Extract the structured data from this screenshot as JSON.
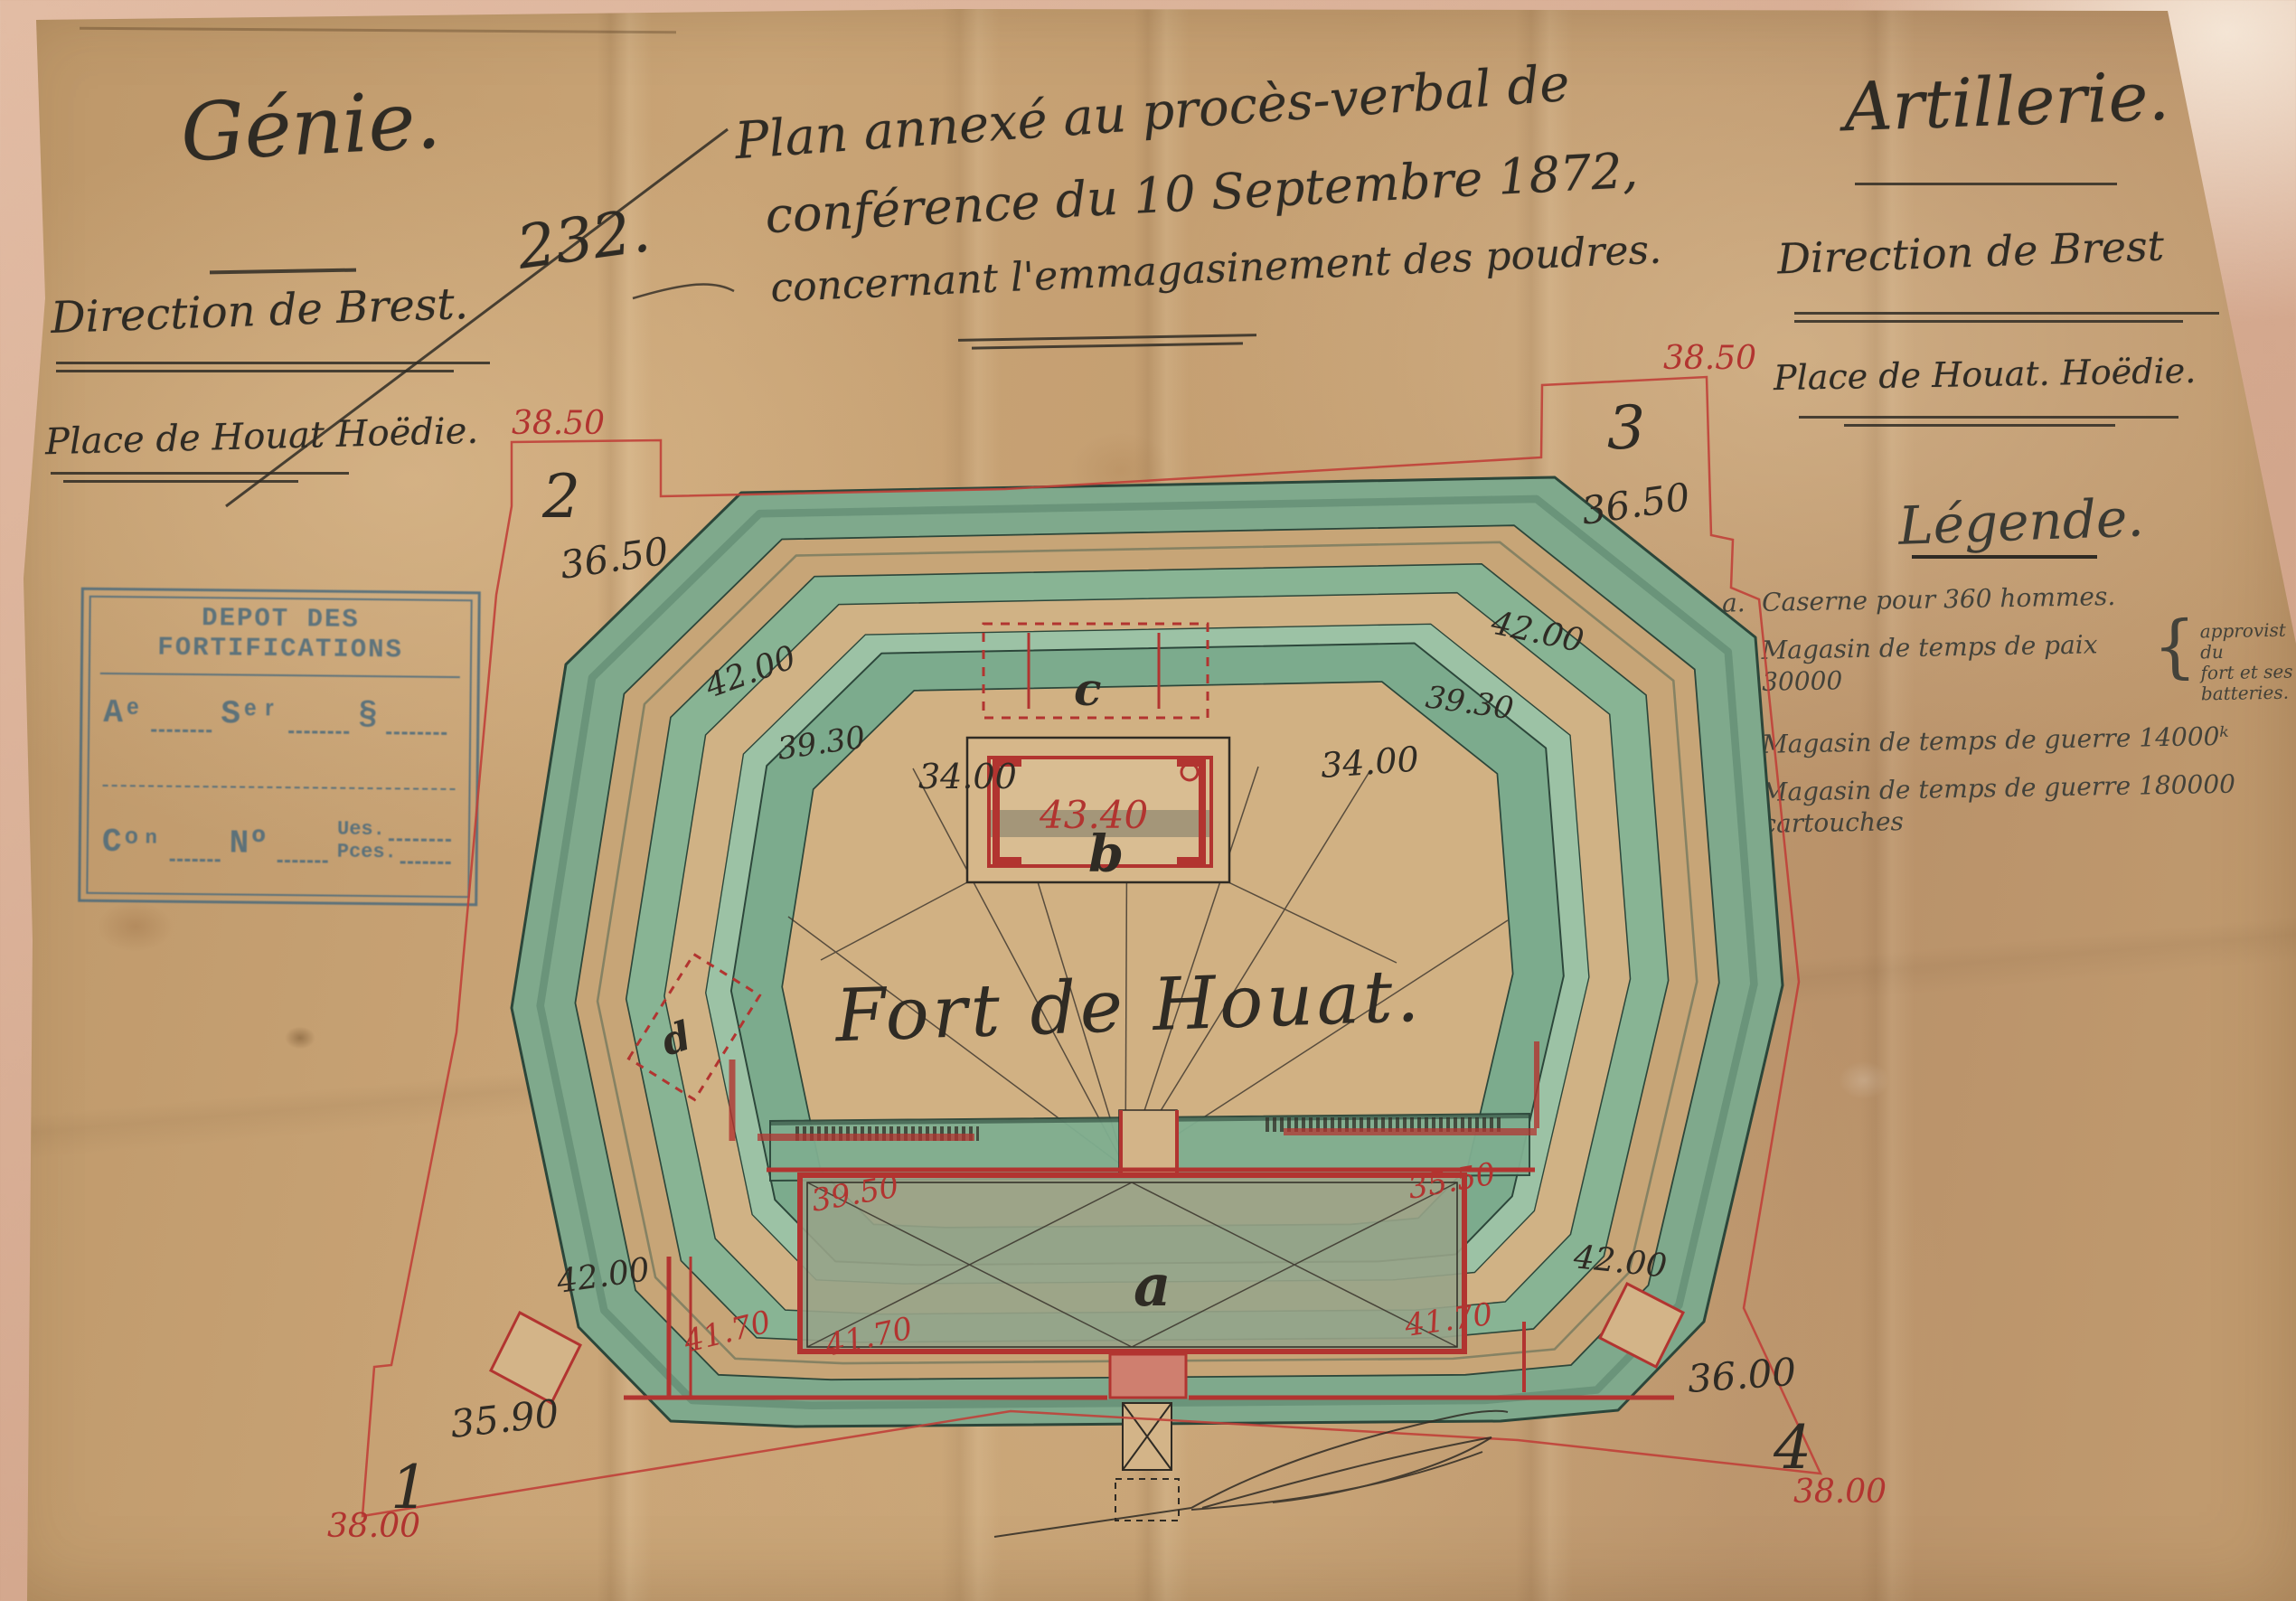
{
  "document": {
    "header_left": {
      "service": "Génie.",
      "direction": "Direction de Brest.",
      "place": "Place de Houat Hoëdie."
    },
    "header_center": {
      "doc_number": "232.",
      "title_line1": "Plan annexé au procès-verbal de",
      "title_line2": "conférence du 10 Septembre 1872,",
      "title_line3": "concernant l'emmagasinement des poudres."
    },
    "header_right": {
      "service": "Artillerie.",
      "direction": "Direction de Brest",
      "place": "Place de Houat. Hoëdie."
    }
  },
  "stamp": {
    "title": "DEPOT DES FORTIFICATIONS",
    "field_an": "Aᵉ",
    "field_ser": "Sᵉʳ",
    "field_par": "§",
    "field_con": "Cᵒⁿ",
    "field_no": "Nº",
    "field_ues": "Ues.",
    "field_pces": "Pces."
  },
  "legend": {
    "title": "Légende.",
    "brace": "{",
    "items": [
      {
        "key": "a.",
        "text": "Caserne pour 360 hommes."
      },
      {
        "key": "b.",
        "text": "Magasin de temps de paix 30000",
        "note_lines": [
          "approvist du",
          "fort et ses",
          "batteries."
        ]
      },
      {
        "key": "c.",
        "text": "Magasin de temps de guerre 14000ᵏ"
      },
      {
        "key": "d.",
        "text": "Magasin de temps de guerre 180000 cartouches"
      }
    ]
  },
  "plan": {
    "fort_name": "Fort de Houat.",
    "corners": {
      "p1": {
        "num": "1",
        "boundary_elev": "38.00",
        "ground_elev": "35.90"
      },
      "p2": {
        "num": "2",
        "boundary_elev": "38.50",
        "ground_elev": "36.50"
      },
      "p3": {
        "num": "3",
        "boundary_elev": "38.50",
        "ground_elev": "36.50"
      },
      "p4": {
        "num": "4",
        "boundary_elev": "38.00",
        "ground_elev": "36.00"
      }
    },
    "elevations": {
      "rampart_nw": "42.00",
      "rampart_ne": "42.00",
      "rampart_sw": "42.00",
      "rampart_se": "42.00",
      "terreplein_w": "39.30",
      "terreplein_e": "39.30",
      "parade_w": "34.00",
      "parade_e": "34.00",
      "magazine_roof": "43.40",
      "caserne_nw": "39.50",
      "caserne_ne": "35.50",
      "caserne_sw": "41.70",
      "caserne_se": "41.70",
      "caserne_road": "41.70"
    },
    "buildings": {
      "a": "a",
      "b": "b",
      "c": "c",
      "d": "d"
    }
  },
  "colors": {
    "ink": "#2f2b24",
    "red_ink": "#b23430",
    "stamp_blue": "#46687c",
    "glacis_green": "#7fa98c",
    "paper_tan": "#c49e70"
  }
}
